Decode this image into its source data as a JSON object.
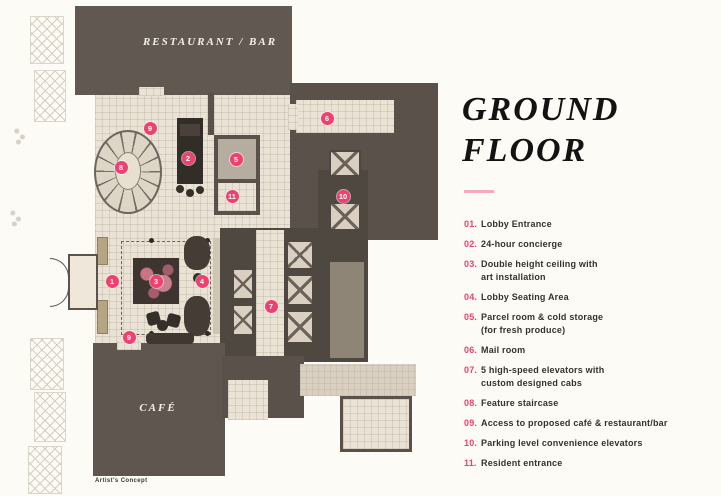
{
  "plan": {
    "restaurant_label": "RESTAURANT / BAR",
    "cafe_label": "CAFÉ",
    "artists_concept": "Artist's Concept",
    "markers": [
      {
        "n": "1",
        "x": 112,
        "y": 281
      },
      {
        "n": "2",
        "x": 188,
        "y": 158
      },
      {
        "n": "3",
        "x": 156,
        "y": 281
      },
      {
        "n": "4",
        "x": 202,
        "y": 281
      },
      {
        "n": "5",
        "x": 236,
        "y": 159
      },
      {
        "n": "6",
        "x": 327,
        "y": 118
      },
      {
        "n": "7",
        "x": 271,
        "y": 306
      },
      {
        "n": "8",
        "x": 121,
        "y": 167
      },
      {
        "n": "9",
        "x": 150,
        "y": 128
      },
      {
        "n": "9",
        "x": 129,
        "y": 337
      },
      {
        "n": "10",
        "x": 343,
        "y": 196
      },
      {
        "n": "11",
        "x": 232,
        "y": 196
      }
    ]
  },
  "panel": {
    "title_line1": "GROUND",
    "title_line2": "FLOOR",
    "legend": [
      {
        "num": "01.",
        "text": "Lobby Entrance"
      },
      {
        "num": "02.",
        "text": "24-hour concierge"
      },
      {
        "num": "03.",
        "text": "Double height ceiling with\nart installation"
      },
      {
        "num": "04.",
        "text": "Lobby Seating Area"
      },
      {
        "num": "05.",
        "text": "Parcel room & cold storage\n(for fresh produce)"
      },
      {
        "num": "06.",
        "text": "Mail room"
      },
      {
        "num": "07.",
        "text": "5 high-speed elevators with\ncustom designed cabs"
      },
      {
        "num": "08.",
        "text": "Feature staircase"
      },
      {
        "num": "09.",
        "text": "Access to proposed café & restaurant/bar"
      },
      {
        "num": "10.",
        "text": "Parking level convenience elevators"
      },
      {
        "num": "11.",
        "text": "Resident entrance"
      }
    ]
  },
  "colors": {
    "accent_pink": "#f0406f",
    "divider_pink": "#f7a8ba",
    "wall_dark": "#5a524a",
    "floor_tile": "#eae2d4"
  }
}
